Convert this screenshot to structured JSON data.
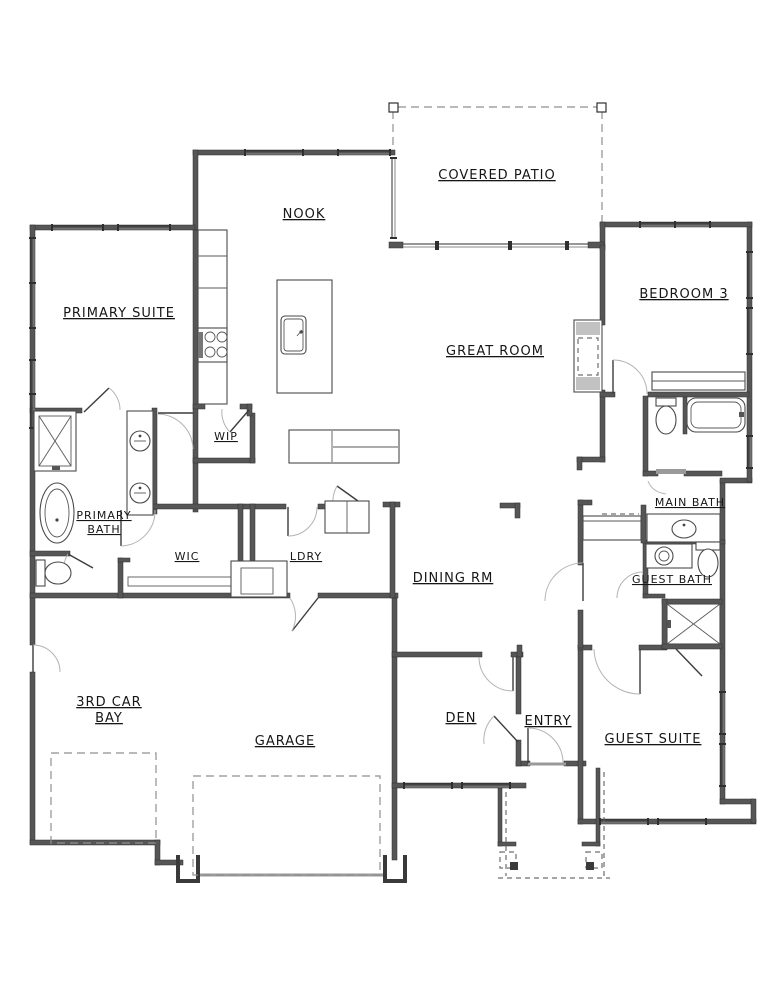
{
  "drawing": {
    "type": "residential-floor-plan",
    "background_color": "#ffffff",
    "wall_color": "#565656",
    "text_color": "#161616",
    "rooms": [
      {
        "id": "covered-patio",
        "label": "COVERED PATIO"
      },
      {
        "id": "nook",
        "label": "NOOK"
      },
      {
        "id": "primary-suite",
        "label": "PRIMARY SUITE"
      },
      {
        "id": "bedroom-3",
        "label": "BEDROOM 3"
      },
      {
        "id": "great-room",
        "label": "GREAT ROOM"
      },
      {
        "id": "wip",
        "label": "WIP"
      },
      {
        "id": "primary-bath",
        "label": "PRIMARY",
        "label2": "BATH"
      },
      {
        "id": "wic",
        "label": "WIC"
      },
      {
        "id": "ldry",
        "label": "LDRY"
      },
      {
        "id": "main-bath",
        "label": "MAIN BATH"
      },
      {
        "id": "guest-bath",
        "label": "GUEST BATH"
      },
      {
        "id": "dining-rm",
        "label": "DINING RM"
      },
      {
        "id": "third-car-bay",
        "label": "3RD CAR",
        "label2": "BAY"
      },
      {
        "id": "garage",
        "label": "GARAGE"
      },
      {
        "id": "den",
        "label": "DEN"
      },
      {
        "id": "entry",
        "label": "ENTRY"
      },
      {
        "id": "guest-suite",
        "label": "GUEST SUITE"
      }
    ],
    "fixtures": [
      "kitchen-island-sink",
      "range-cooktop",
      "refrigerator-counter",
      "primary-shower",
      "primary-freestanding-tub",
      "primary-double-vanity",
      "primary-toilet",
      "main-bath-tub",
      "main-bath-toilet",
      "main-bath-vanity",
      "guest-bath-vanity",
      "guest-bath-toilet",
      "guest-shower",
      "washer-dryer",
      "mud-bench",
      "closet-shelf",
      "media-niche",
      "built-in-cabinet",
      "garage-door-overhead",
      "bay-door-overhead",
      "porch-columns",
      "covered-patio-roofline"
    ]
  }
}
